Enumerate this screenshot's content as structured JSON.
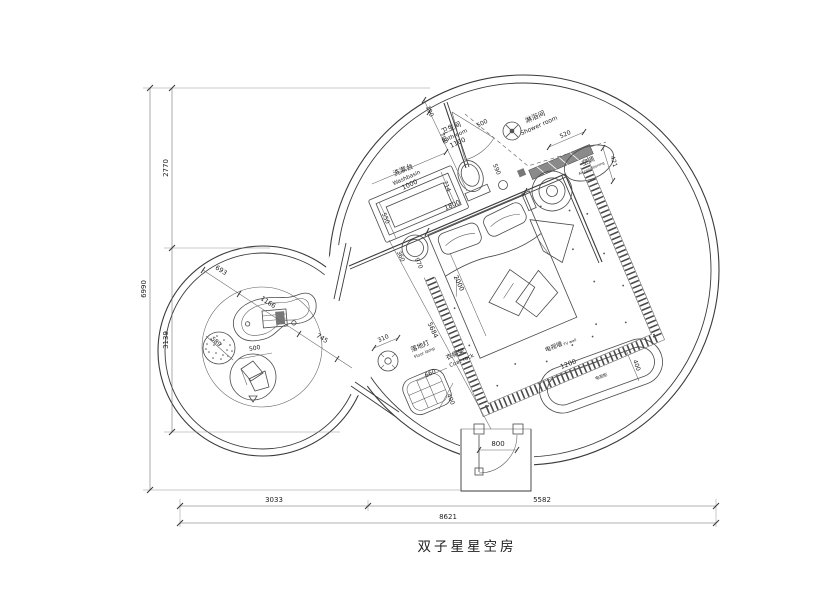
{
  "title": "双子星星空房",
  "rooms": {
    "washbasin": {
      "zh": "洗漱台",
      "en": "Washbasin"
    },
    "bathroom": {
      "zh": "卫生间",
      "en": "Bathroom"
    },
    "shower": {
      "zh": "淋浴间",
      "en": "Shower room"
    },
    "ac": {
      "zh": "空调",
      "en": "Air-conditioning"
    },
    "floor_lamp": {
      "zh": "落地灯",
      "en": "Floor lamp"
    },
    "coat_rack": {
      "zh": "衣帽架",
      "en": "Coat rack"
    },
    "tv_wall": {
      "zh": "电视墙",
      "en": "TV wall"
    },
    "tv_cabinet": {
      "zh": "电视柜"
    }
  },
  "dims": {
    "overall_width": "8621",
    "bottom_left": "3033",
    "bottom_right": "5582",
    "overall_height": "6990",
    "left_upper": "2770",
    "left_lower": "3139",
    "washbasin_length": "1000",
    "washbasin_depth": "550",
    "bathroom_length": "1100",
    "wall_gap": "190",
    "bathroom_door": "700",
    "shower_door": "500",
    "shower_length": "520",
    "ac_offset": "421",
    "drain_offset": "590",
    "toilet_width": "714",
    "bed_width": "1800",
    "bed_length": "2000",
    "stool_diameter": "360",
    "stool_offset": "970",
    "room_diagonal": "5684",
    "left_seg_a": "693",
    "desk_length": "1166",
    "left_seg_b": "745",
    "pouf_diameter": "589",
    "cushion_diameter": "500",
    "lamp_diameter": "310",
    "coat_rack_length": "660",
    "coat_rack_depth": "400",
    "tv_cabinet_length": "1200",
    "tv_cabinet_depth": "400",
    "entry_door": "800"
  }
}
